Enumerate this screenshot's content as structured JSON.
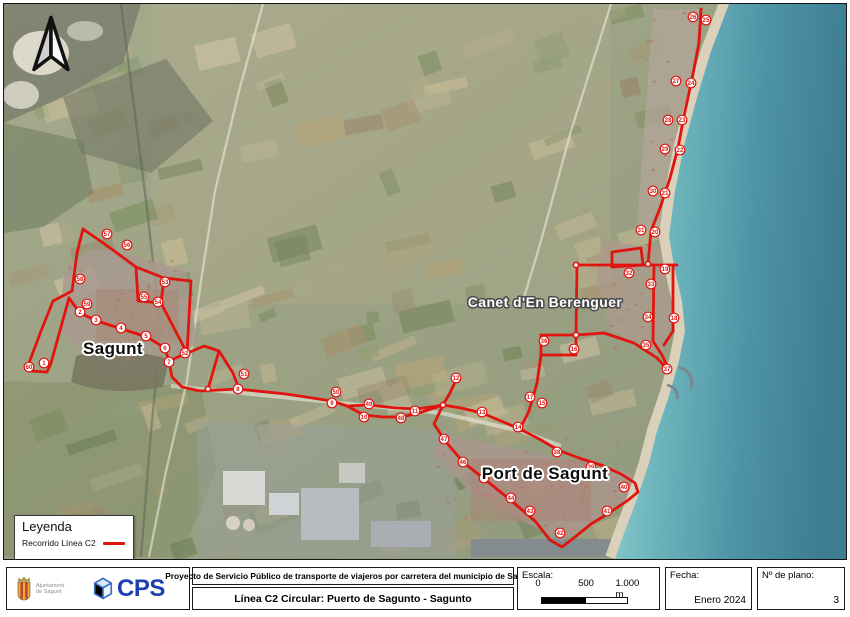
{
  "map": {
    "route_color": "#e1140e",
    "places": [
      {
        "name": "Sagunt",
        "x": 112,
        "y": 353,
        "style": "dark",
        "size": 17
      },
      {
        "name": "Canet d'En Berenguer",
        "x": 544,
        "y": 306,
        "style": "light",
        "size": 14
      },
      {
        "name": "Port de Sagunt",
        "x": 544,
        "y": 478,
        "style": "dark",
        "size": 17
      }
    ],
    "stops": [
      {
        "n": "1",
        "x": 43,
        "y": 362
      },
      {
        "n": "2",
        "x": 79,
        "y": 311
      },
      {
        "n": "3",
        "x": 95,
        "y": 319
      },
      {
        "n": "4",
        "x": 120,
        "y": 327
      },
      {
        "n": "5",
        "x": 145,
        "y": 335
      },
      {
        "n": "6",
        "x": 164,
        "y": 347
      },
      {
        "n": "7",
        "x": 168,
        "y": 361
      },
      {
        "n": "8",
        "x": 237,
        "y": 388
      },
      {
        "n": "9",
        "x": 331,
        "y": 402
      },
      {
        "n": "10",
        "x": 363,
        "y": 416
      },
      {
        "n": "11",
        "x": 414,
        "y": 410
      },
      {
        "n": "12",
        "x": 455,
        "y": 377
      },
      {
        "n": "13",
        "x": 481,
        "y": 411
      },
      {
        "n": "14",
        "x": 517,
        "y": 426
      },
      {
        "n": "15",
        "x": 541,
        "y": 402
      },
      {
        "n": "16",
        "x": 573,
        "y": 348
      },
      {
        "n": "17",
        "x": 529,
        "y": 396
      },
      {
        "n": "18",
        "x": 673,
        "y": 317
      },
      {
        "n": "19",
        "x": 664,
        "y": 268
      },
      {
        "n": "20",
        "x": 654,
        "y": 231
      },
      {
        "n": "21",
        "x": 664,
        "y": 192
      },
      {
        "n": "22",
        "x": 679,
        "y": 149
      },
      {
        "n": "23",
        "x": 681,
        "y": 119
      },
      {
        "n": "24",
        "x": 690,
        "y": 82
      },
      {
        "n": "25",
        "x": 705,
        "y": 19
      },
      {
        "n": "26",
        "x": 692,
        "y": 16
      },
      {
        "n": "27",
        "x": 675,
        "y": 80
      },
      {
        "n": "28",
        "x": 667,
        "y": 119
      },
      {
        "n": "29",
        "x": 664,
        "y": 148
      },
      {
        "n": "30",
        "x": 652,
        "y": 190
      },
      {
        "n": "31",
        "x": 640,
        "y": 229
      },
      {
        "n": "32",
        "x": 628,
        "y": 272
      },
      {
        "n": "33",
        "x": 650,
        "y": 283
      },
      {
        "n": "34",
        "x": 647,
        "y": 316
      },
      {
        "n": "35",
        "x": 645,
        "y": 344
      },
      {
        "n": "36",
        "x": 543,
        "y": 340
      },
      {
        "n": "37",
        "x": 666,
        "y": 368
      },
      {
        "n": "38",
        "x": 556,
        "y": 451
      },
      {
        "n": "39",
        "x": 590,
        "y": 466
      },
      {
        "n": "40",
        "x": 623,
        "y": 486
      },
      {
        "n": "41",
        "x": 606,
        "y": 510
      },
      {
        "n": "42",
        "x": 559,
        "y": 532
      },
      {
        "n": "43",
        "x": 529,
        "y": 510
      },
      {
        "n": "44",
        "x": 510,
        "y": 497
      },
      {
        "n": "45",
        "x": 483,
        "y": 477
      },
      {
        "n": "46",
        "x": 462,
        "y": 461
      },
      {
        "n": "47",
        "x": 443,
        "y": 438
      },
      {
        "n": "48",
        "x": 400,
        "y": 417
      },
      {
        "n": "49",
        "x": 368,
        "y": 403
      },
      {
        "n": "50",
        "x": 335,
        "y": 391
      },
      {
        "n": "51",
        "x": 243,
        "y": 373
      },
      {
        "n": "52",
        "x": 184,
        "y": 352
      },
      {
        "n": "53",
        "x": 164,
        "y": 281
      },
      {
        "n": "54",
        "x": 157,
        "y": 301
      },
      {
        "n": "55",
        "x": 143,
        "y": 296
      },
      {
        "n": "56",
        "x": 126,
        "y": 244
      },
      {
        "n": "57",
        "x": 106,
        "y": 233
      },
      {
        "n": "58",
        "x": 79,
        "y": 278
      },
      {
        "n": "59",
        "x": 86,
        "y": 303
      },
      {
        "n": "60",
        "x": 28,
        "y": 366
      }
    ],
    "segments": [
      [
        [
          700,
          8
        ],
        [
          698,
          42
        ],
        [
          691,
          78
        ],
        [
          683,
          115
        ],
        [
          677,
          147
        ],
        [
          669,
          177
        ],
        [
          659,
          207
        ],
        [
          650,
          230
        ],
        [
          647,
          263
        ]
      ],
      [
        [
          576,
          264
        ],
        [
          676,
          264
        ]
      ],
      [
        [
          611,
          251
        ],
        [
          640,
          247
        ],
        [
          642,
          264
        ],
        [
          611,
          266
        ],
        [
          611,
          251
        ]
      ],
      [
        [
          576,
          264
        ],
        [
          575,
          335
        ]
      ],
      [
        [
          540,
          334
        ],
        [
          575,
          334
        ],
        [
          575,
          354
        ],
        [
          540,
          354
        ],
        [
          540,
          334
        ]
      ],
      [
        [
          540,
          354
        ],
        [
          536,
          382
        ],
        [
          528,
          410
        ],
        [
          519,
          428
        ]
      ],
      [
        [
          653,
          264
        ],
        [
          652,
          340
        ],
        [
          661,
          354
        ],
        [
          669,
          371
        ]
      ],
      [
        [
          672,
          264
        ],
        [
          672,
          330
        ],
        [
          663,
          344
        ]
      ],
      [
        [
          575,
          334
        ],
        [
          603,
          332
        ],
        [
          633,
          342
        ],
        [
          656,
          357
        ],
        [
          669,
          371
        ]
      ],
      [
        [
          168,
          361
        ],
        [
          171,
          376
        ],
        [
          181,
          386
        ],
        [
          199,
          390
        ],
        [
          237,
          388
        ],
        [
          285,
          393
        ],
        [
          331,
          400
        ],
        [
          346,
          405
        ],
        [
          363,
          414
        ],
        [
          382,
          416
        ],
        [
          401,
          416
        ],
        [
          421,
          411
        ],
        [
          442,
          404
        ]
      ],
      [
        [
          346,
          405
        ],
        [
          368,
          404
        ],
        [
          395,
          407
        ],
        [
          415,
          408
        ],
        [
          430,
          406
        ],
        [
          442,
          404
        ]
      ],
      [
        [
          218,
          350
        ],
        [
          207,
          388
        ]
      ],
      [
        [
          218,
          350
        ],
        [
          232,
          372
        ],
        [
          238,
          388
        ]
      ],
      [
        [
          187,
          352
        ],
        [
          203,
          345
        ],
        [
          218,
          350
        ]
      ],
      [
        [
          442,
          404
        ],
        [
          449,
          392
        ],
        [
          455,
          379
        ]
      ],
      [
        [
          442,
          404
        ],
        [
          460,
          407
        ],
        [
          481,
          412
        ],
        [
          500,
          420
        ],
        [
          519,
          428
        ],
        [
          540,
          439
        ],
        [
          557,
          449
        ],
        [
          578,
          457
        ],
        [
          600,
          464
        ],
        [
          620,
          473
        ],
        [
          634,
          482
        ],
        [
          637,
          491
        ],
        [
          626,
          500
        ],
        [
          608,
          512
        ],
        [
          590,
          523
        ],
        [
          574,
          536
        ],
        [
          561,
          546
        ],
        [
          549,
          539
        ],
        [
          534,
          520
        ],
        [
          513,
          502
        ],
        [
          486,
          480
        ],
        [
          463,
          462
        ],
        [
          445,
          441
        ],
        [
          433,
          423
        ],
        [
          442,
          404
        ]
      ],
      [
        [
          82,
          228
        ],
        [
          105,
          244
        ],
        [
          135,
          266
        ]
      ],
      [
        [
          82,
          228
        ],
        [
          76,
          252
        ],
        [
          71,
          290
        ]
      ],
      [
        [
          71,
          290
        ],
        [
          52,
          300
        ],
        [
          40,
          330
        ],
        [
          28,
          362
        ],
        [
          30,
          370
        ],
        [
          46,
          371
        ],
        [
          50,
          362
        ],
        [
          68,
          297
        ]
      ],
      [
        [
          68,
          297
        ],
        [
          79,
          312
        ],
        [
          96,
          320
        ],
        [
          121,
          328
        ],
        [
          146,
          336
        ],
        [
          164,
          347
        ],
        [
          168,
          361
        ]
      ],
      [
        [
          135,
          266
        ],
        [
          163,
          277
        ],
        [
          160,
          302
        ],
        [
          137,
          300
        ],
        [
          135,
          266
        ]
      ],
      [
        [
          163,
          277
        ],
        [
          190,
          280
        ],
        [
          186,
          352
        ],
        [
          168,
          360
        ]
      ],
      [
        [
          160,
          302
        ],
        [
          173,
          327
        ],
        [
          186,
          352
        ]
      ]
    ],
    "nodes": [
      [
        442,
        404
      ],
      [
        331,
        401
      ],
      [
        519,
        428
      ],
      [
        575,
        334
      ],
      [
        647,
        263
      ],
      [
        186,
        352
      ],
      [
        168,
        361
      ],
      [
        207,
        388
      ],
      [
        575,
        264
      ]
    ]
  },
  "legend": {
    "title": "Leyenda",
    "items": [
      {
        "label": "Recorrido Línea C2",
        "color": "#e1140e"
      }
    ]
  },
  "footer": {
    "org_line1": "Ajuntament",
    "org_line2": "de Sagunt",
    "cps_text": "CPS",
    "project_title": "Proyecto de Servicio Público de transporte de viajeros por carretera del municipio de Sagunto",
    "plan_title": "Línea C2 Circular: Puerto de Sagunto - Sagunto",
    "scale_label": "Escala:",
    "scale_ticks": [
      "0",
      "500",
      "1.000 m"
    ],
    "date_label": "Fecha:",
    "date_value": "Enero 2024",
    "plan_label": "Nº de plano:",
    "plan_value": "3"
  }
}
